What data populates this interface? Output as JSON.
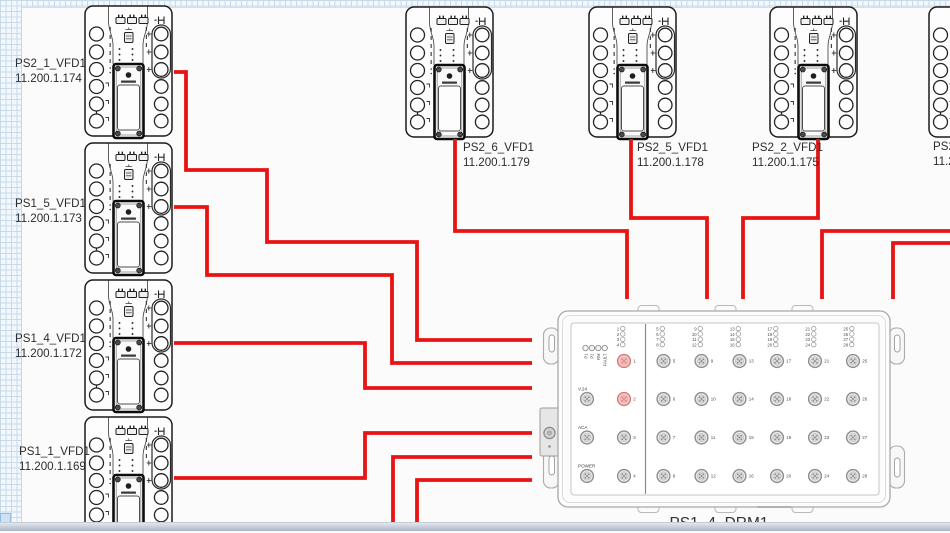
{
  "canvas": {
    "sheet_color": "#fbfbfb",
    "grid_line_color": "#c6daec",
    "cable_color": "#e81414",
    "highlight_port_color": "#dd7373"
  },
  "devices": [
    {
      "name": "PS2_1_VFD1",
      "ip": "11.200.1.174"
    },
    {
      "name": "PS1_5_VFD1",
      "ip": "11.200.1.173"
    },
    {
      "name": "PS1_4_VFD1",
      "ip": "11.200.1.172"
    },
    {
      "name": "PS1_1_VFD1",
      "ip": "11.200.1.169"
    },
    {
      "name": "PS2_6_VFD1",
      "ip": "11.200.1.179"
    },
    {
      "name": "PS2_5_VFD1",
      "ip": "11.200.1.178"
    },
    {
      "name": "PS2_2_VFD1",
      "ip": "11.200.1.175"
    },
    {
      "name": "PS2_",
      "ip": "11.2"
    }
  ],
  "drm": {
    "name": "PS1_4_DRM1",
    "status_leds": [
      "P1",
      "P2",
      "RM",
      "FAULT"
    ],
    "side_ports": [
      "V.24",
      "ACA",
      "POWER"
    ],
    "port_numbers": [
      1,
      2,
      3,
      4,
      5,
      6,
      7,
      8,
      9,
      10,
      11,
      12,
      13,
      14,
      15,
      16,
      17,
      18,
      19,
      20,
      21,
      22,
      23,
      24,
      25,
      26,
      27,
      28
    ],
    "red_ports": [
      1,
      2
    ]
  },
  "cables": [
    {
      "id": "ps2-1-vfd1",
      "from": "PS2_1_VFD1",
      "to": "PS1_4_DRM1",
      "points": [
        [
          174,
          72
        ],
        [
          186,
          72
        ],
        [
          186,
          170
        ],
        [
          267,
          170
        ],
        [
          267,
          242
        ],
        [
          417,
          242
        ],
        [
          417,
          340
        ],
        [
          532,
          340
        ]
      ]
    },
    {
      "id": "ps1-5-vfd1",
      "from": "PS1_5_VFD1",
      "to": "PS1_4_DRM1",
      "points": [
        [
          174,
          207
        ],
        [
          207,
          207
        ],
        [
          207,
          275
        ],
        [
          392,
          275
        ],
        [
          392,
          363
        ],
        [
          532,
          363
        ]
      ]
    },
    {
      "id": "ps1-4-vfd1",
      "from": "PS1_4_VFD1",
      "to": "PS1_4_DRM1",
      "points": [
        [
          174,
          343
        ],
        [
          365,
          343
        ],
        [
          365,
          388
        ],
        [
          532,
          388
        ]
      ]
    },
    {
      "id": "ps1-1-vfd1",
      "from": "PS1_1_VFD1",
      "to": "PS1_4_DRM1",
      "points": [
        [
          174,
          478
        ],
        [
          365,
          478
        ],
        [
          365,
          433
        ],
        [
          532,
          433
        ]
      ]
    },
    {
      "id": "offscreen-bottom-1",
      "from": "offscreen-bottom",
      "to": "PS1_4_DRM1",
      "points": [
        [
          393,
          532
        ],
        [
          393,
          457
        ],
        [
          532,
          457
        ]
      ]
    },
    {
      "id": "offscreen-bottom-2",
      "from": "offscreen-bottom",
      "to": "PS1_4_DRM1",
      "points": [
        [
          417,
          532
        ],
        [
          417,
          480
        ],
        [
          532,
          480
        ]
      ]
    },
    {
      "id": "ps2-6-vfd1",
      "from": "PS2_6_VFD1",
      "to": "PS1_4_DRM1",
      "points": [
        [
          455,
          139
        ],
        [
          455,
          231
        ],
        [
          627,
          231
        ],
        [
          627,
          299
        ]
      ]
    },
    {
      "id": "ps2-5-vfd1",
      "from": "PS2_5_VFD1",
      "to": "PS1_4_DRM1",
      "points": [
        [
          631,
          139
        ],
        [
          631,
          218
        ],
        [
          707,
          218
        ],
        [
          707,
          299
        ]
      ]
    },
    {
      "id": "ps2-2-vfd1",
      "from": "PS2_2_VFD1",
      "to": "PS1_4_DRM1",
      "points": [
        [
          818,
          139
        ],
        [
          818,
          218
        ],
        [
          743,
          218
        ],
        [
          743,
          299
        ]
      ]
    },
    {
      "id": "offscreen-right-1",
      "from": "offscreen-right",
      "to": "PS1_4_DRM1",
      "points": [
        [
          952,
          231
        ],
        [
          822,
          231
        ],
        [
          822,
          299
        ]
      ]
    },
    {
      "id": "offscreen-right-2",
      "from": "offscreen-right",
      "to": "PS1_4_DRM1",
      "points": [
        [
          952,
          243
        ],
        [
          893,
          243
        ],
        [
          893,
          299
        ]
      ]
    }
  ]
}
